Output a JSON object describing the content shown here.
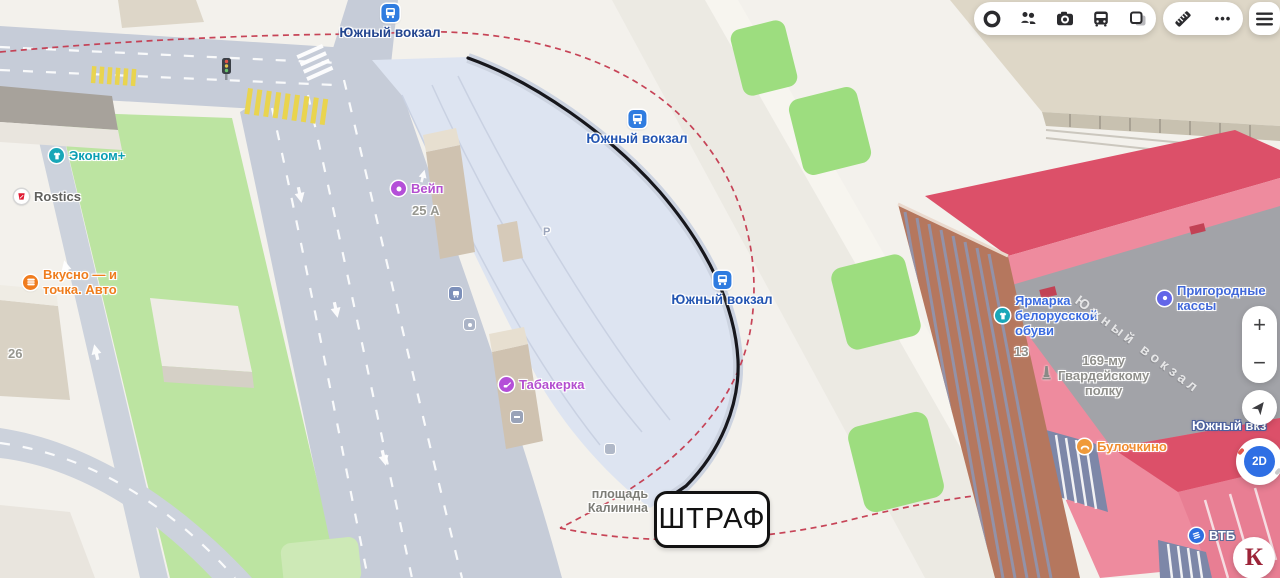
{
  "toolbar": {
    "icons": [
      "traffic-ring-icon",
      "friends-icon",
      "camera-icon",
      "bus-transport-icon",
      "panorama-layers-icon",
      "ruler-icon",
      "more-dots-icon",
      "menu-hamburger-icon"
    ],
    "more_dots": "•••"
  },
  "controls": {
    "zoom_in": "+",
    "zoom_out": "−",
    "mode": "2D"
  },
  "transit_stops": [
    {
      "label": "Южный вокзал"
    },
    {
      "label": "Южный вокзал"
    },
    {
      "label": "Южный вокзал"
    }
  ],
  "pois": {
    "ekonom": "Эконом+",
    "rostics": "Rostics",
    "vkusno": [
      "Вкусно — и",
      "точка. Авто"
    ],
    "veip": "Вейп",
    "tabakerka": "Табакерка",
    "yarmarka": [
      "Ярмарка",
      "белорусской",
      "обуви"
    ],
    "prigorodnye": [
      "Пригородные",
      "кассы"
    ],
    "gvardeyskomu": [
      "169-му",
      "Гвардейскому",
      "полку"
    ],
    "bulochkino": "Булочкино",
    "vtb": "ВТБ"
  },
  "places": {
    "square": [
      "площадь",
      "Калинина"
    ],
    "station_building": "Южный вкз",
    "roof_text": "Южный вокзал",
    "house_26": "26",
    "house_25a": "25 А",
    "house_13": "13",
    "parking": "Р"
  },
  "annotations": {
    "penalty": "ШТРАФ"
  },
  "branding": {
    "k_logo": "К"
  },
  "colors": {
    "stop_icon": "#2f7ce0",
    "route_dashed": "#c43a4f",
    "selected_line": "#17171c",
    "station_pink": "#ee8b9e",
    "station_red": "#dc5069",
    "green_patch": "#9ddd7f",
    "road": "#c6ccd8",
    "terminal_area": "#dde4f1"
  }
}
